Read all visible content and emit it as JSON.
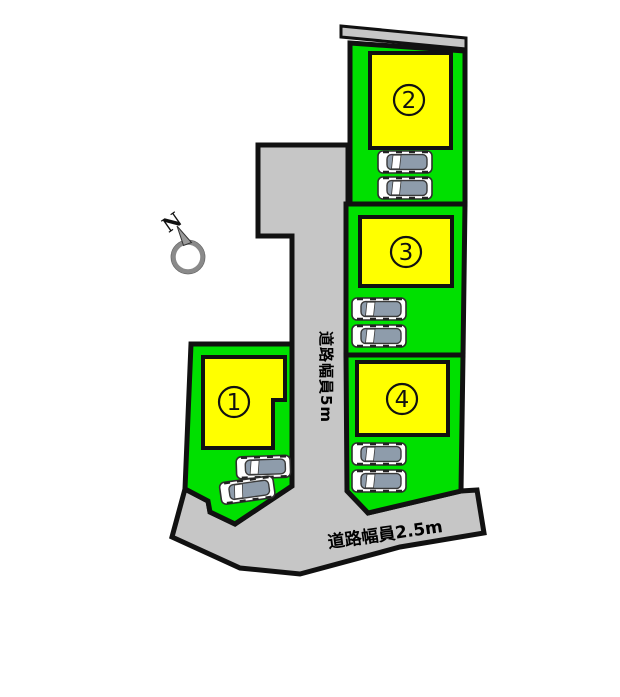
{
  "compass": {
    "label": "N"
  },
  "roads": {
    "vertical_label": "道路幅員5m",
    "bottom_label": "道路幅員2.5m"
  },
  "plots": [
    {
      "label": "1"
    },
    {
      "label": "2"
    },
    {
      "label": "3"
    },
    {
      "label": "4"
    }
  ],
  "colors": {
    "plot-green": "#00e000",
    "building-yellow": "#ffff00",
    "road-gray": "#c6c6c6",
    "outline-black": "#111111",
    "car-roof-gray": "#8e9cab",
    "compass-gray": "#8a8a8a"
  }
}
